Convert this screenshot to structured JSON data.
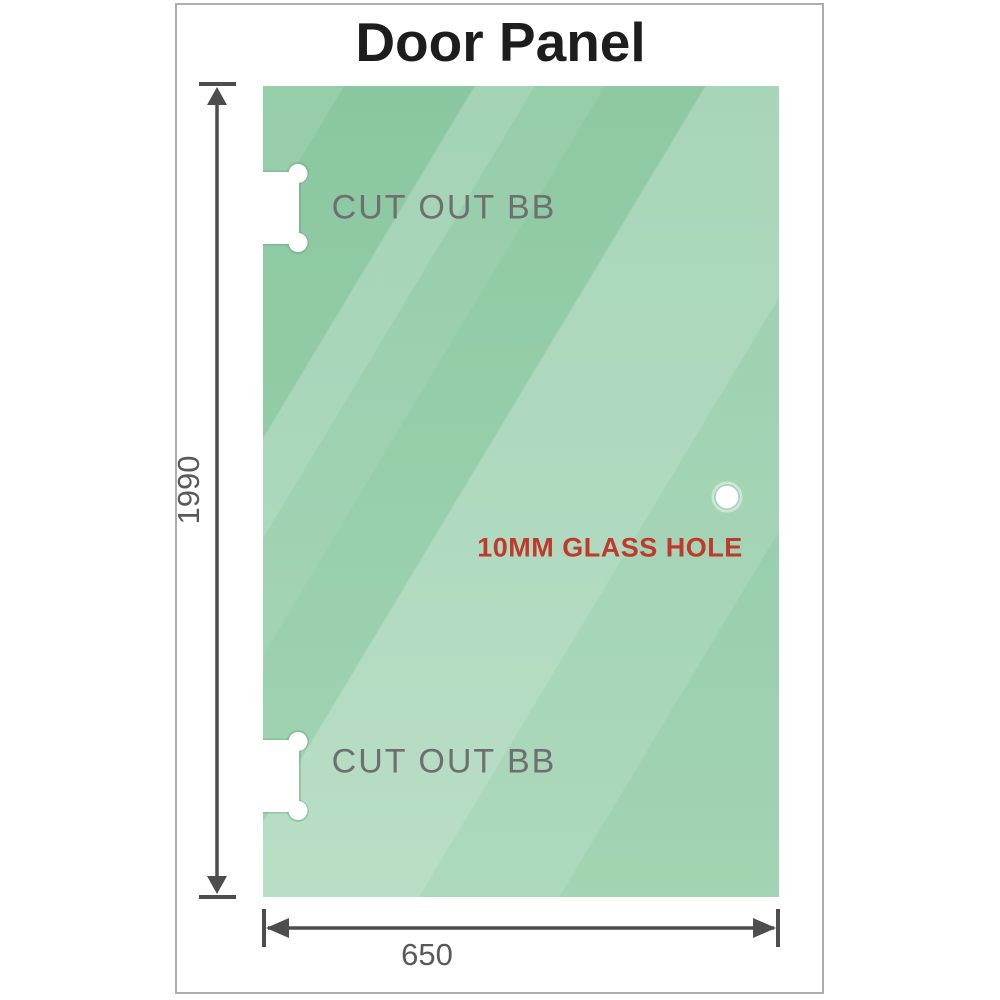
{
  "title": "Door Panel",
  "panel": {
    "upper_cutout_label": "CUT OUT BB",
    "lower_cutout_label": "CUT OUT BB",
    "hole_label": "10MM GLASS HOLE"
  },
  "dimensions": {
    "height_label": "1990",
    "width_label": "650"
  },
  "icons": {
    "height_dimension": "double-arrow-vertical-icon",
    "width_dimension": "double-arrow-horizontal-icon"
  },
  "colors": {
    "glass-base": "#8ac7a0",
    "glass-light": "#a0d3b1",
    "dimension-line": "#4d4d4d",
    "cutout-label": "#6f6f6f",
    "dim-label": "#595959",
    "hole-label": "#c0392b",
    "frame-border": "#adadad",
    "title": "#1d1d1d"
  }
}
